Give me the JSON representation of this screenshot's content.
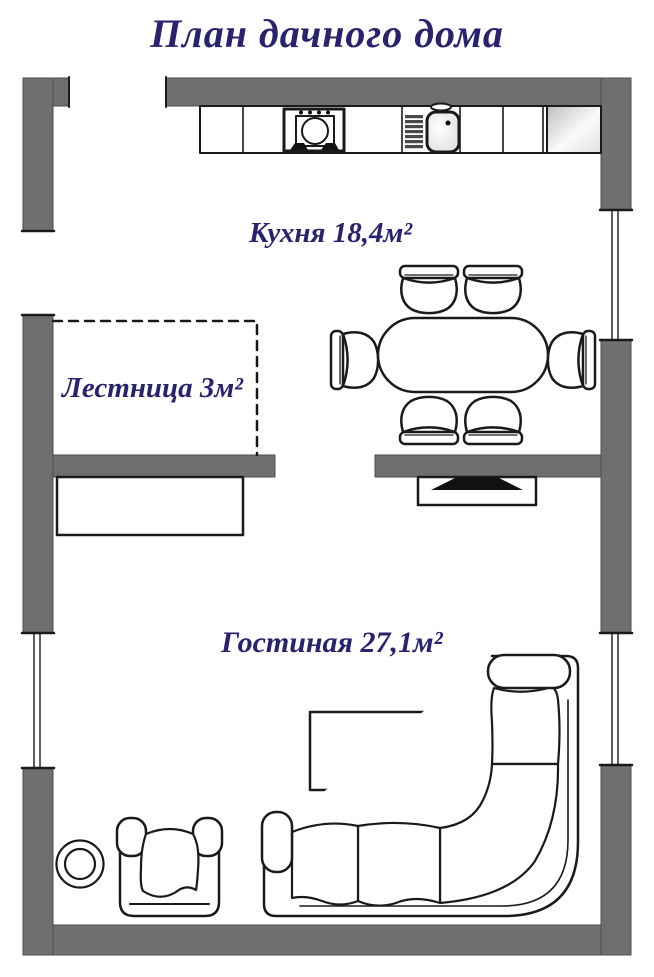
{
  "title": "План дачного дома",
  "rooms": {
    "kitchen": {
      "label": "Кухня 18,4м²"
    },
    "staircase": {
      "label": "Лестница 3м²"
    },
    "living": {
      "label": "Гостиная 27,1м²"
    }
  },
  "colors": {
    "wall": "#6f6f6f",
    "label": "#29226e",
    "outline": "#1a1a1a"
  },
  "furniture_icons": [
    "kitchen-counter",
    "stove-icon",
    "sink-icon",
    "corner-cabinet",
    "dining-table",
    "dining-chair",
    "staircase-area",
    "sideboard",
    "tv-stand",
    "tv-icon",
    "coffee-table",
    "corner-sofa",
    "armchair",
    "round-side-table"
  ]
}
